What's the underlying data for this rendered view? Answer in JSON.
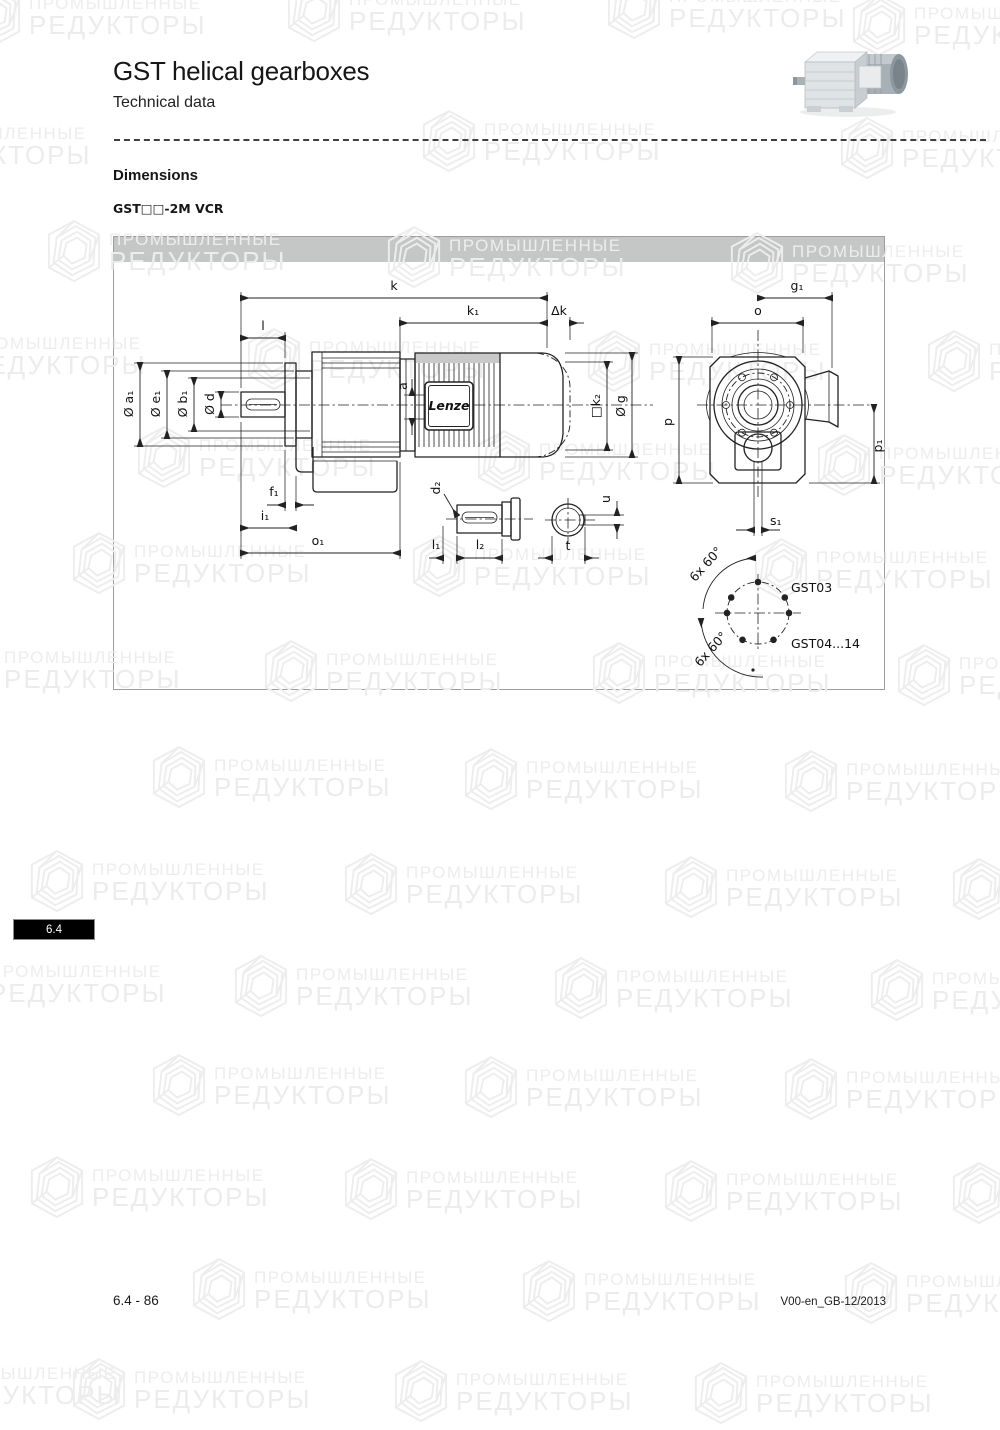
{
  "page": {
    "title": "GST helical gearboxes",
    "subtitle": "Technical data",
    "section_heading": "Dimensions",
    "variant_label": "GST□□-2M VCR",
    "side_tab": "6.4",
    "footer_left": "6.4 - 86",
    "footer_right": "V00-en_GB-12/2013"
  },
  "watermark": {
    "line1": "ПРОМЫШЛЕННЫЕ",
    "line2": "РЕДУКТОРЫ"
  },
  "drawing": {
    "brand": "Lenze",
    "labels": {
      "k": "k",
      "k1": "k₁",
      "dk": "Δk",
      "l": "l",
      "a": "a",
      "da1": "Ø a₁",
      "de1": "Ø e₁",
      "db1": "Ø b₁",
      "dd": "Ø d",
      "k2": "□k₂",
      "dg": "Ø g",
      "f1": "f₁",
      "i1": "i₁",
      "o1": "o₁",
      "d2": "d₂",
      "l1": "l₁",
      "l2": "l₂",
      "t": "t",
      "u": "u",
      "g1": "g₁",
      "o": "o",
      "p": "p",
      "p1": "p₁",
      "s1": "s₁",
      "bolt_note": "6x 60°",
      "bolt_label_top": "GST03",
      "bolt_label_bottom": "GST04...14"
    },
    "colors": {
      "band": "#c5c7c7",
      "line": "#222222",
      "motor_strip": "#c9c9c9"
    }
  }
}
